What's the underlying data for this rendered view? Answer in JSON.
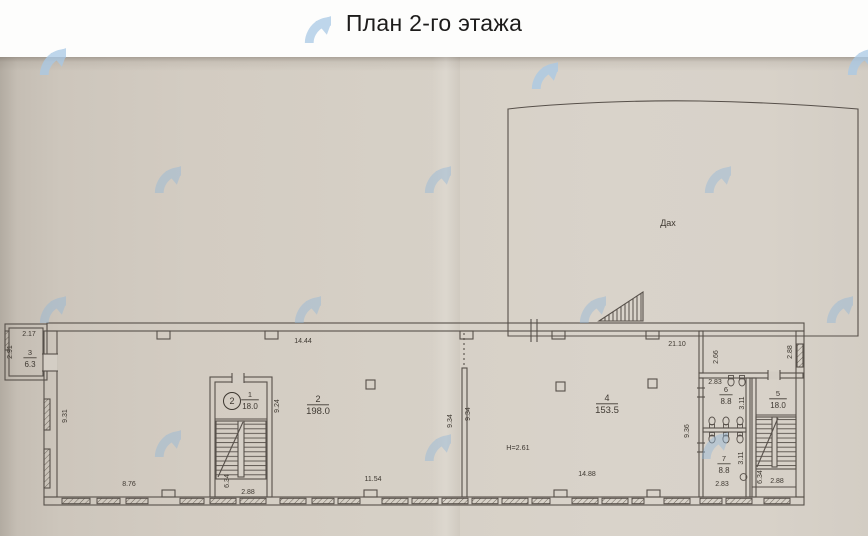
{
  "header": {
    "title": "План 2-го этажа"
  },
  "plan": {
    "roof_label": "Дах",
    "height_note": "H=2.61",
    "rooms": [
      {
        "number": "3",
        "area": "6.3",
        "x": 30,
        "y": 357
      },
      {
        "number": "1",
        "area": "18.0",
        "x": 250,
        "y": 399
      },
      {
        "number": "2",
        "area": "198.0",
        "x": 318,
        "y": 404
      },
      {
        "number": "4",
        "area": "153.5",
        "x": 607,
        "y": 403
      },
      {
        "number": "5",
        "area": "18.0",
        "x": 778,
        "y": 398
      },
      {
        "number": "6",
        "area": "8.8",
        "x": 726,
        "y": 394
      },
      {
        "number": "7",
        "area": "8.8",
        "x": 724,
        "y": 463
      }
    ],
    "stair_marker": {
      "label": "2",
      "x": 232,
      "y": 401
    },
    "dimensions_horizontal": [
      {
        "text": "2.17",
        "x": 29,
        "y": 336
      },
      {
        "text": "14.44",
        "x": 303,
        "y": 343
      },
      {
        "text": "21.10",
        "x": 677,
        "y": 346
      },
      {
        "text": "8.76",
        "x": 129,
        "y": 486
      },
      {
        "text": "2.88",
        "x": 248,
        "y": 494
      },
      {
        "text": "11.54",
        "x": 373,
        "y": 481
      },
      {
        "text": "14.88",
        "x": 587,
        "y": 476
      },
      {
        "text": "2.83",
        "x": 715,
        "y": 384
      },
      {
        "text": "2.83",
        "x": 722,
        "y": 486
      },
      {
        "text": "2.88",
        "x": 777,
        "y": 483
      }
    ],
    "dimensions_vertical": [
      {
        "text": "2.91",
        "x": 12,
        "y": 352
      },
      {
        "text": "9.31",
        "x": 67,
        "y": 416
      },
      {
        "text": "9.24",
        "x": 279,
        "y": 406
      },
      {
        "text": "6.34",
        "x": 229,
        "y": 481
      },
      {
        "text": "9.34",
        "x": 452,
        "y": 421
      },
      {
        "text": "9.34",
        "x": 470,
        "y": 414
      },
      {
        "text": "9.36",
        "x": 689,
        "y": 431
      },
      {
        "text": "2.66",
        "x": 718,
        "y": 357
      },
      {
        "text": "2.88",
        "x": 792,
        "y": 352
      },
      {
        "text": "3.11",
        "x": 744,
        "y": 403
      },
      {
        "text": "3.11",
        "x": 743,
        "y": 458
      },
      {
        "text": "6.34",
        "x": 762,
        "y": 477
      }
    ]
  },
  "colors": {
    "line": "#57504a",
    "label_text": "#3e3831",
    "watermark_blue": "#8fb6da",
    "paper": "#d6d0c6"
  },
  "watermark_icon_name": "circular-arrow-logo"
}
